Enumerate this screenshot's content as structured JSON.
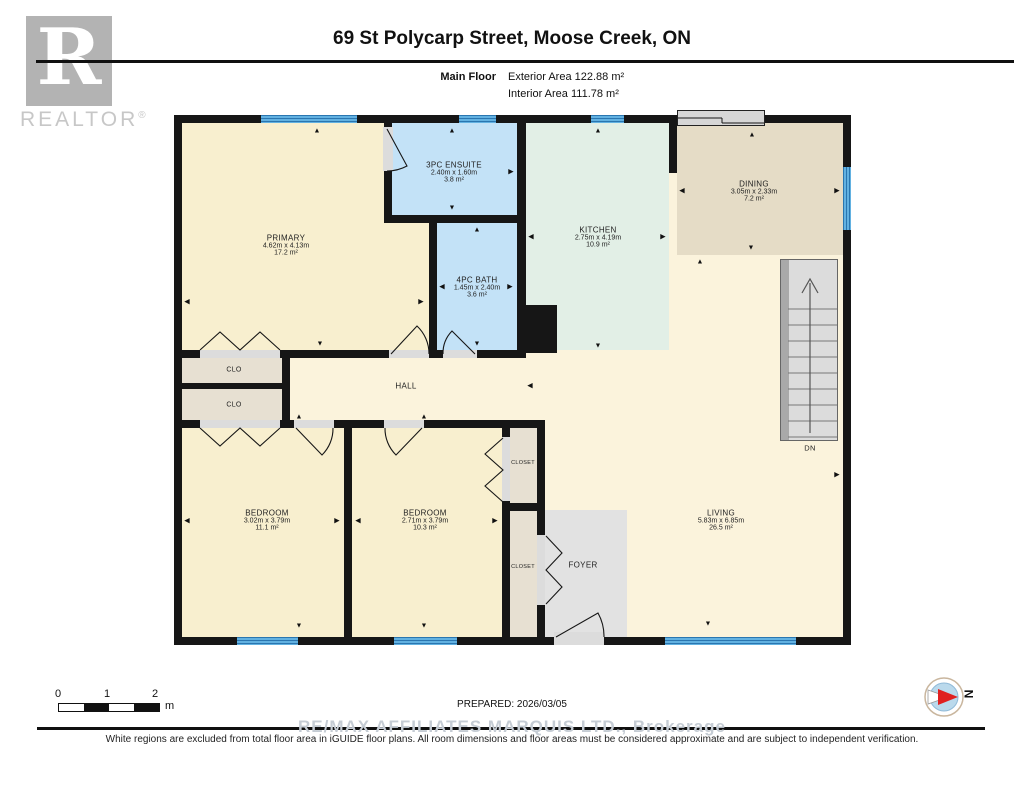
{
  "header": {
    "title": "69 St Polycarp Street, Moose Creek, ON",
    "floor_label": "Main Floor",
    "exterior_area": "Exterior Area 122.88 m²",
    "interior_area": "Interior Area 111.78 m²",
    "realtor_logo_letter": "R",
    "realtor_logo_word": "REALTOR",
    "realtor_logo_reg": "®"
  },
  "plan": {
    "rooms": [
      {
        "id": "primary",
        "name": "PRIMARY",
        "dims": "4.62m x 4.13m",
        "area": "17.2 m²",
        "x": 112,
        "y": 130
      },
      {
        "id": "ensuite",
        "name": "3PC ENSUITE",
        "dims": "2.40m x 1.60m",
        "area": "3.8 m²",
        "x": 280,
        "y": 57
      },
      {
        "id": "bath",
        "name": "4PC BATH",
        "dims": "1.45m x 2.40m",
        "area": "3.6 m²",
        "x": 303,
        "y": 172
      },
      {
        "id": "kitchen",
        "name": "KITCHEN",
        "dims": "2.75m x 4.19m",
        "area": "10.9 m²",
        "x": 424,
        "y": 122
      },
      {
        "id": "dining",
        "name": "DINING",
        "dims": "3.05m x 2.33m",
        "area": "7.2 m²",
        "x": 580,
        "y": 76
      },
      {
        "id": "bedroom-1",
        "name": "BEDROOM",
        "dims": "3.02m x 3.79m",
        "area": "11.1 m²",
        "x": 93,
        "y": 405
      },
      {
        "id": "bedroom-2",
        "name": "BEDROOM",
        "dims": "2.71m x 3.79m",
        "area": "10.3 m²",
        "x": 251,
        "y": 405
      },
      {
        "id": "living",
        "name": "LIVING",
        "dims": "5.83m x 6.85m",
        "area": "26.5 m²",
        "x": 547,
        "y": 405
      }
    ],
    "small_labels": [
      {
        "id": "clo-1",
        "text": "CLO",
        "x": 60,
        "y": 255,
        "size": 7
      },
      {
        "id": "clo-2",
        "text": "CLO",
        "x": 60,
        "y": 290,
        "size": 7
      },
      {
        "id": "hall",
        "text": "HALL",
        "x": 232,
        "y": 271,
        "size": 8
      },
      {
        "id": "closet-1",
        "text": "CLOSET",
        "x": 349,
        "y": 348,
        "size": 5.5
      },
      {
        "id": "closet-2",
        "text": "CLOSET",
        "x": 349,
        "y": 452,
        "size": 5.5
      },
      {
        "id": "foyer",
        "text": "FOYER",
        "x": 409,
        "y": 450,
        "size": 8
      },
      {
        "id": "stairs-down",
        "text": "DN",
        "x": 636,
        "y": 333,
        "size": 7.5
      }
    ],
    "arrows": [
      {
        "d": "u",
        "x": 143,
        "y": 16
      },
      {
        "d": "l",
        "x": 13,
        "y": 187
      },
      {
        "d": "r",
        "x": 247,
        "y": 187
      },
      {
        "d": "d",
        "x": 146,
        "y": 229
      },
      {
        "d": "u",
        "x": 278,
        "y": 16
      },
      {
        "d": "r",
        "x": 337,
        "y": 57
      },
      {
        "d": "d",
        "x": 278,
        "y": 93
      },
      {
        "d": "u",
        "x": 303,
        "y": 115
      },
      {
        "d": "l",
        "x": 268,
        "y": 172
      },
      {
        "d": "r",
        "x": 336,
        "y": 172
      },
      {
        "d": "d",
        "x": 303,
        "y": 229
      },
      {
        "d": "u",
        "x": 424,
        "y": 16
      },
      {
        "d": "l",
        "x": 357,
        "y": 122
      },
      {
        "d": "r",
        "x": 489,
        "y": 122
      },
      {
        "d": "d",
        "x": 424,
        "y": 231
      },
      {
        "d": "u",
        "x": 578,
        "y": 20
      },
      {
        "d": "l",
        "x": 508,
        "y": 76
      },
      {
        "d": "r",
        "x": 663,
        "y": 76
      },
      {
        "d": "d",
        "x": 577,
        "y": 133
      },
      {
        "d": "l",
        "x": 356,
        "y": 271
      },
      {
        "d": "u",
        "x": 526,
        "y": 147
      },
      {
        "d": "r",
        "x": 663,
        "y": 360
      },
      {
        "d": "d",
        "x": 534,
        "y": 509
      },
      {
        "d": "u",
        "x": 125,
        "y": 302
      },
      {
        "d": "l",
        "x": 13,
        "y": 406
      },
      {
        "d": "r",
        "x": 163,
        "y": 406
      },
      {
        "d": "d",
        "x": 125,
        "y": 511
      },
      {
        "d": "u",
        "x": 250,
        "y": 302
      },
      {
        "d": "l",
        "x": 184,
        "y": 406
      },
      {
        "d": "r",
        "x": 321,
        "y": 406
      },
      {
        "d": "d",
        "x": 250,
        "y": 511
      }
    ]
  },
  "icons": {
    "arrow_up": "▲",
    "arrow_down": "▼",
    "arrow_left": "◀",
    "arrow_right": "▶",
    "compass_needle": "compass-needle",
    "stairs_up_arrow": "stairs-up-arrow"
  },
  "colors": {
    "wall": "#161616",
    "cream_room": "#f8efcf",
    "cream_open": "#fbf3dc",
    "bath_blue": "#c3e2f7",
    "kitchen_green": "#e2efe6",
    "dining_tan": "#e5dcc6",
    "closet_tan": "#e7e0d2",
    "foyer_gray": "#e2e2e2",
    "window_blue": "#62b1e1",
    "compass_red": "#e02020"
  },
  "footer": {
    "scale_ticks": [
      "0",
      "1",
      "2"
    ],
    "scale_unit": "m",
    "prepared": "PREPARED: 2026/03/05",
    "watermark": "RE/MAX AFFILIATES MARQUIS LTD., Brokerage",
    "disclaimer": "White regions are excluded from total floor area in iGUIDE floor plans. All room dimensions and floor areas must be considered approximate and are subject to independent verification.",
    "compass_north": "N"
  }
}
